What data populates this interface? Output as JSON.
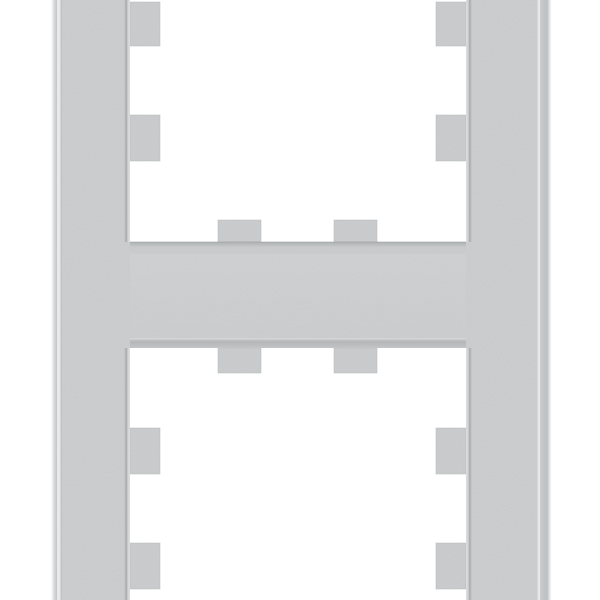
{
  "image": {
    "type": "product-photo",
    "subject": "vertical two-gang light-switch cover frame, silver aluminium finish, square openings with notched mounting tabs, cropped at top and bottom edges"
  },
  "colors": {
    "background": "#ffffff",
    "frame_base": "#c6c8c9",
    "tab_fill": "#c4c6c8",
    "chamfer_light": "#dcdddd",
    "chamfer_dark": "#a8abad",
    "edge_line_dark": "#9ea1a3",
    "edge_highlight": "#e8e9ea",
    "bevel_mid": "#bfc1c3"
  }
}
